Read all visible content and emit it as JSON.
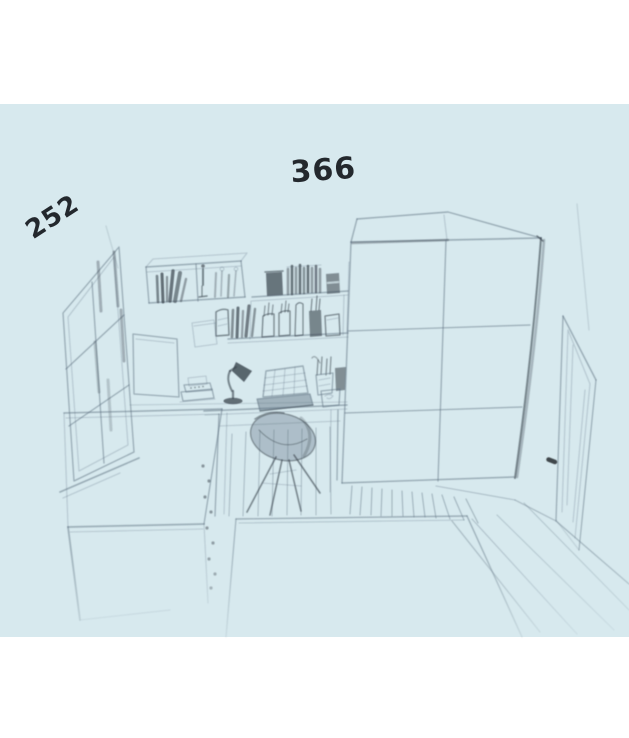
{
  "annotations": {
    "left_wall_dimension": "252",
    "back_wall_dimension": "366"
  },
  "colors": {
    "background": "#ffffff",
    "paper": "#d7e9ee",
    "ink": "#5e7080",
    "ink_dark": "#39434c",
    "ink_black": "#23282d"
  },
  "scene": {
    "type": "hand-drawn pencil sketch of a bedroom interior on light blue paper",
    "objects": [
      "window",
      "bed with drawers",
      "poster board",
      "wall shelves with books, figurines and jars",
      "desk",
      "desk lamp",
      "laptop",
      "pen cups",
      "book stack",
      "shell desk chair",
      "rug",
      "wooden plank floor",
      "two-door wardrobe",
      "door with handle"
    ]
  }
}
